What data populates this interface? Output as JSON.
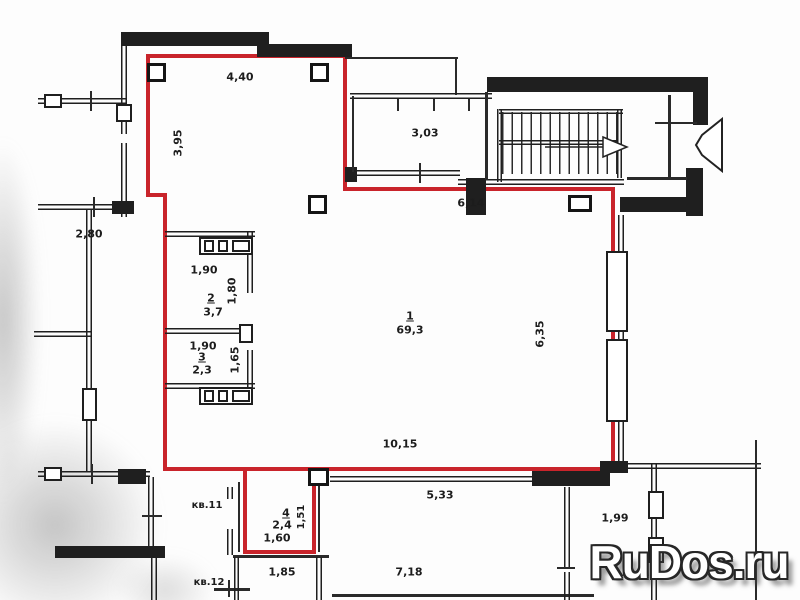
{
  "colors": {
    "boundary_red": "#c9242b",
    "wall_black": "#1f1f1f"
  },
  "rooms": [
    {
      "number": "1",
      "area": "69,3"
    },
    {
      "number": "2",
      "area": "3,7"
    },
    {
      "number": "3",
      "area": "2,3"
    },
    {
      "number": "4",
      "area": "2,4"
    }
  ],
  "dimensions": {
    "top_room_width": "4,40",
    "top_room_height": "3,95",
    "hall_width": "3,03",
    "main_top_width": "6,14",
    "left_room_width": "2,80",
    "room2_width": "1,90",
    "room2_height": "1,80",
    "room3_width": "1,90",
    "room3_height": "1,65",
    "main_right_height": "6,35",
    "main_bottom_width": "10,15",
    "below_width": "5,33",
    "room4_width": "1,60",
    "room4_height": "1,51",
    "kv12_hall_width": "1,85",
    "bottom_width": "7,18",
    "right_bottom_width": "1,99"
  },
  "apartment_labels": {
    "kv11": "кв.11",
    "kv12": "кв.12"
  },
  "watermark": {
    "text": "RuDos.ru"
  }
}
